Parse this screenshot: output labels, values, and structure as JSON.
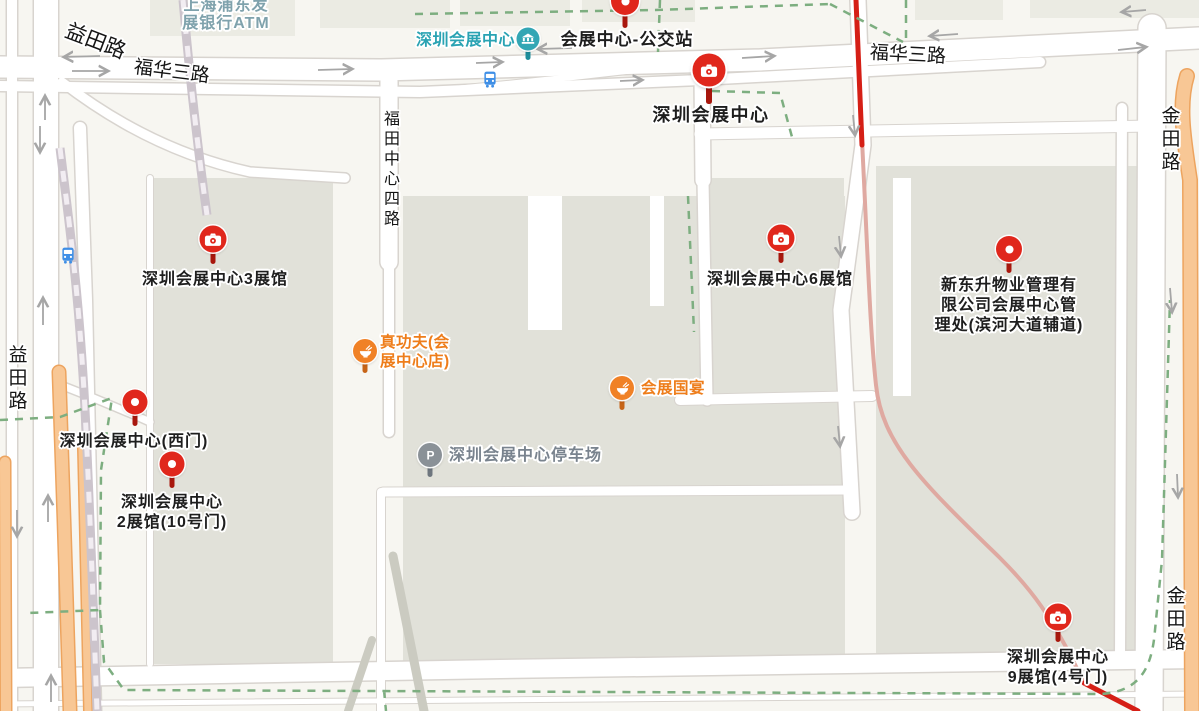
{
  "colors": {
    "background": "#F7F6F1",
    "building": "#E1E1D9",
    "building_light": "#EBEBE3",
    "road_casing": "#D8D4CF",
    "road_fill": "#FFFFFF",
    "orange_road_fill": "#F8C795",
    "orange_road_edge": "#EDA45F",
    "gray_path": "#CBCBC1",
    "rail": "#CCC4CC",
    "rail_dash": "#F2EDF2",
    "route_red": "#D51F16",
    "route_faded": "#DFA9A1",
    "boundary_green": "#7DAE80",
    "arrow_gray": "#A6A6A6",
    "pin_red": "#E0271C",
    "pin_red_stem": "#A8170D",
    "poi_orange": "#F08126",
    "poi_orange_stem": "#C76417",
    "poi_gray": "#8A9197",
    "poi_gray_stem": "#6E767E",
    "metro_teal": "#33A6B4",
    "metro_teal_stem": "#1E8D9B",
    "bus_blue": "#3F8FE6",
    "label_black": "#1E1E1E",
    "label_orange": "#EE7D1A",
    "label_gray": "#79838E",
    "label_teal": "#2AA3B3",
    "label_teal_muted": "#7FA2AC",
    "road_label": "#151515"
  },
  "road_labels": [
    {
      "text": "益田路",
      "x": 96,
      "y": 40,
      "rotate": 21,
      "size": 21,
      "vertical": false
    },
    {
      "text": "福华三路",
      "x": 172,
      "y": 70,
      "rotate": 7,
      "size": 19,
      "vertical": false
    },
    {
      "text": "福华三路",
      "x": 908,
      "y": 53,
      "rotate": 3,
      "size": 19,
      "vertical": false
    },
    {
      "text": "福田中心四路",
      "x": 389,
      "y": 170,
      "rotate": 0,
      "size": 16,
      "vertical": true
    },
    {
      "text": "益田路",
      "x": 16,
      "y": 379,
      "rotate": 0,
      "size": 19,
      "vertical": true
    },
    {
      "text": "金田路",
      "x": 1169,
      "y": 140,
      "rotate": 0,
      "size": 19,
      "vertical": true
    },
    {
      "text": "金田路",
      "x": 1174,
      "y": 620,
      "rotate": 0,
      "size": 19,
      "vertical": true
    }
  ],
  "markers": [
    {
      "id": "bus-stop-pin",
      "type": "dot-pin",
      "x": 625,
      "y": 1,
      "d": 28,
      "stem": 13,
      "label_lines": [
        "会展中心-公交站"
      ],
      "label_x": 627,
      "label_y": 30,
      "label_align": "center",
      "label_style": "black-lg"
    },
    {
      "id": "shenzhen-convention-center",
      "type": "camera-pin",
      "selected": true,
      "x": 709,
      "y": 70,
      "d": 33,
      "stem": 17,
      "label_lines": [
        "深圳会展中心"
      ],
      "label_x": 711,
      "label_y": 104,
      "label_align": "center",
      "label_style": "black-xl"
    },
    {
      "id": "hall-3",
      "type": "camera-pin",
      "x": 213,
      "y": 239,
      "d": 27,
      "stem": 11,
      "label_lines": [
        "深圳会展中心3展馆"
      ],
      "label_x": 215,
      "label_y": 270,
      "label_align": "center",
      "label_style": "black"
    },
    {
      "id": "hall-6",
      "type": "camera-pin",
      "x": 781,
      "y": 238,
      "d": 27,
      "stem": 11,
      "label_lines": [
        "深圳会展中心6展馆"
      ],
      "label_x": 780,
      "label_y": 270,
      "label_align": "center",
      "label_style": "black"
    },
    {
      "id": "hall-9",
      "type": "camera-pin",
      "x": 1058,
      "y": 617,
      "d": 27,
      "stem": 11,
      "label_lines": [
        "深圳会展中心",
        "9展馆(4号门)"
      ],
      "label_x": 1058,
      "label_y": 648,
      "label_align": "center",
      "label_style": "black"
    },
    {
      "id": "west-gate",
      "type": "dot-pin",
      "x": 135,
      "y": 402,
      "d": 25,
      "stem": 11,
      "label_lines": [
        "深圳会展中心(西门)"
      ],
      "label_x": 134,
      "label_y": 432,
      "label_align": "center",
      "label_style": "black"
    },
    {
      "id": "hall-2",
      "type": "dot-pin",
      "x": 172,
      "y": 464,
      "d": 25,
      "stem": 11,
      "label_lines": [
        "深圳会展中心",
        "2展馆(10号门)"
      ],
      "label_x": 172,
      "label_y": 493,
      "label_align": "center",
      "label_style": "black"
    },
    {
      "id": "property-office",
      "type": "dot-pin",
      "x": 1009,
      "y": 249,
      "d": 26,
      "stem": 11,
      "label_lines": [
        "新东升物业管理有",
        "限公司会展中心管",
        "理处(滨河大道辅道)"
      ],
      "label_x": 1009,
      "label_y": 276,
      "label_align": "center",
      "label_style": "black"
    },
    {
      "id": "zhen-gong-fu-restaurant",
      "type": "food-pin",
      "x": 365,
      "y": 351,
      "d": 24,
      "stem": 10,
      "label_lines": [
        "真功夫(会",
        "展中心店)"
      ],
      "label_x": 380,
      "label_y": 333,
      "label_align": "left",
      "label_style": "orange"
    },
    {
      "id": "convention-banquet-restaurant",
      "type": "food-pin",
      "x": 622,
      "y": 388,
      "d": 24,
      "stem": 10,
      "label_lines": [
        "会展国宴"
      ],
      "label_x": 641,
      "label_y": 379,
      "label_align": "left",
      "label_style": "orange"
    },
    {
      "id": "parking-lot",
      "type": "parking-pin",
      "x": 430,
      "y": 455,
      "d": 24,
      "stem": 10,
      "label_lines": [
        "深圳会展中心停车场"
      ],
      "label_x": 449,
      "label_y": 446,
      "label_align": "left",
      "label_style": "gray"
    },
    {
      "id": "metro-station",
      "type": "metro-pin",
      "x": 528,
      "y": 39,
      "d": 23,
      "stem": 9,
      "label_lines": [
        "深圳会展中心"
      ],
      "label_x": 515,
      "label_y": 31,
      "label_align": "right",
      "label_style": "teal"
    },
    {
      "id": "spd-bank-atm",
      "type": "label-only",
      "x": 226,
      "y": -3,
      "label_lines": [
        "上海浦东发",
        "展银行ATM"
      ],
      "label_x": 226,
      "label_y": -3,
      "label_align": "center",
      "label_style": "teal-muted"
    },
    {
      "id": "bus-icon-north",
      "type": "bus-icon",
      "x": 490,
      "y": 82,
      "label_lines": []
    },
    {
      "id": "bus-icon-west",
      "type": "bus-icon",
      "x": 68,
      "y": 258,
      "label_lines": []
    }
  ]
}
